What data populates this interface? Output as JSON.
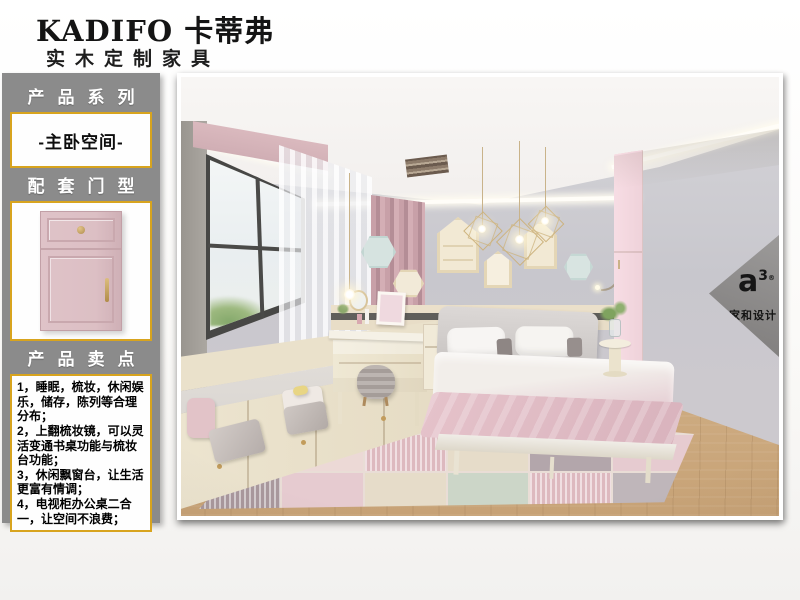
{
  "brand": {
    "name": "KADIFO 卡蒂弗",
    "tagline": "实木定制家具"
  },
  "sidebar": {
    "series_heading": "产品系列",
    "series_value": "-主卧空间-",
    "door_heading": "配套门型",
    "selling_heading": "产品卖点",
    "selling_points": [
      "1，睡眠，梳妆，休闲娱乐，储存，陈列等合理分布；",
      "2，上翻梳妆镜，可以灵活变通书桌功能与梳妆台功能；",
      "3，休闲飘窗台，让生活更富有情调；",
      "4，电视柜办公桌二合一，让空间不浪费；"
    ]
  },
  "watermark": {
    "logo_letter": "a",
    "logo_sup": "3",
    "logo_reg": "®",
    "studio_name": "家和设计"
  },
  "colors": {
    "sidebar_gray": "#8b8b8b",
    "gold_border": "#d8a41e",
    "door_pink": "#dcbfc4",
    "curtain_pink": "#c79fa8",
    "wardrobe_cream": "#eee7d4",
    "wardrobe_pink": "#f5dae1"
  }
}
